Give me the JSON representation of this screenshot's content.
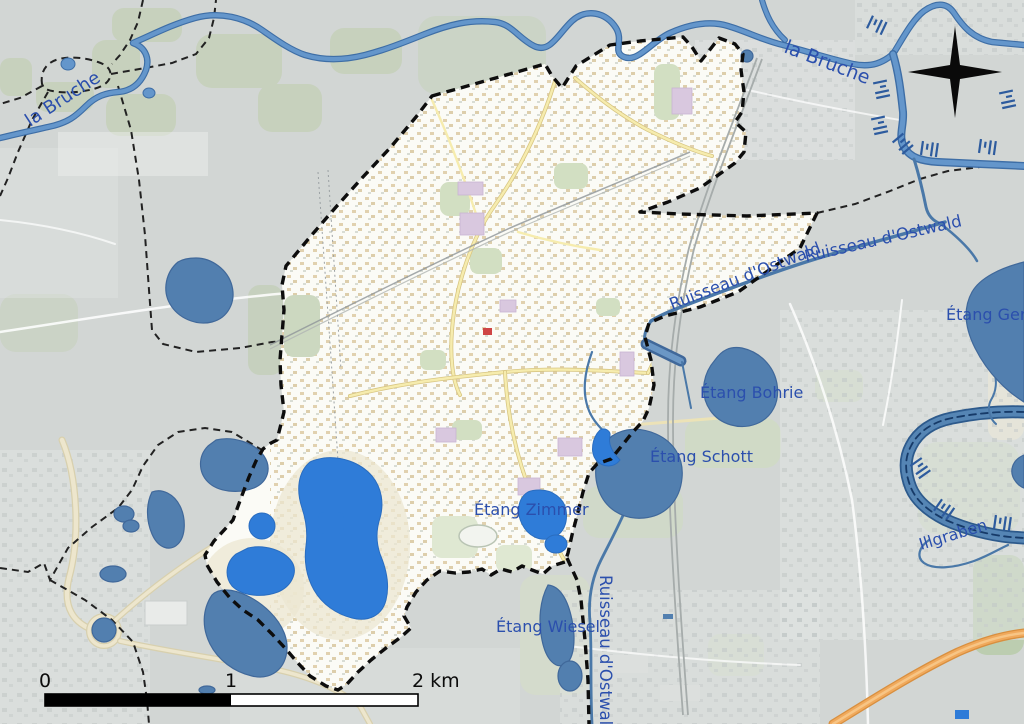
{
  "map": {
    "labels": {
      "bruche_west": "la Bruche",
      "bruche_east": "la Bruche",
      "ruisseau_ostwald_a": "Ruisseau d'Ostwald",
      "ruisseau_ostwald_b": "Ruisseau d'Ostwald",
      "ruisseau_ostwald_s": "Ruisseau d'Ostwald",
      "etang_gerig": "Étang Gerig",
      "etang_bohrie": "Étang Bohrie",
      "etang_schott": "Étang Schott",
      "etang_zimmer": "Étang Zimmer",
      "etang_wiesel": "Étang Wiesel",
      "illgraben": "Illgraben"
    },
    "scale_bar": {
      "tick_start": "0",
      "tick_mid": "1",
      "tick_end": "2 km"
    },
    "colors": {
      "background": "#d2d6d4",
      "commune_fill": "#fbfbf6",
      "boundary": "#0d0d0d",
      "lake_inside": "#2f7cd8",
      "lake_outside": "#527faf",
      "river": "#6496cb",
      "label_blue": "#2b4fad",
      "greenspace": "#c7d1bd",
      "industrial_purple": "#d9c8df",
      "road_yellow": "#f6ecae",
      "motorway_orange": "#f0a95c"
    }
  }
}
